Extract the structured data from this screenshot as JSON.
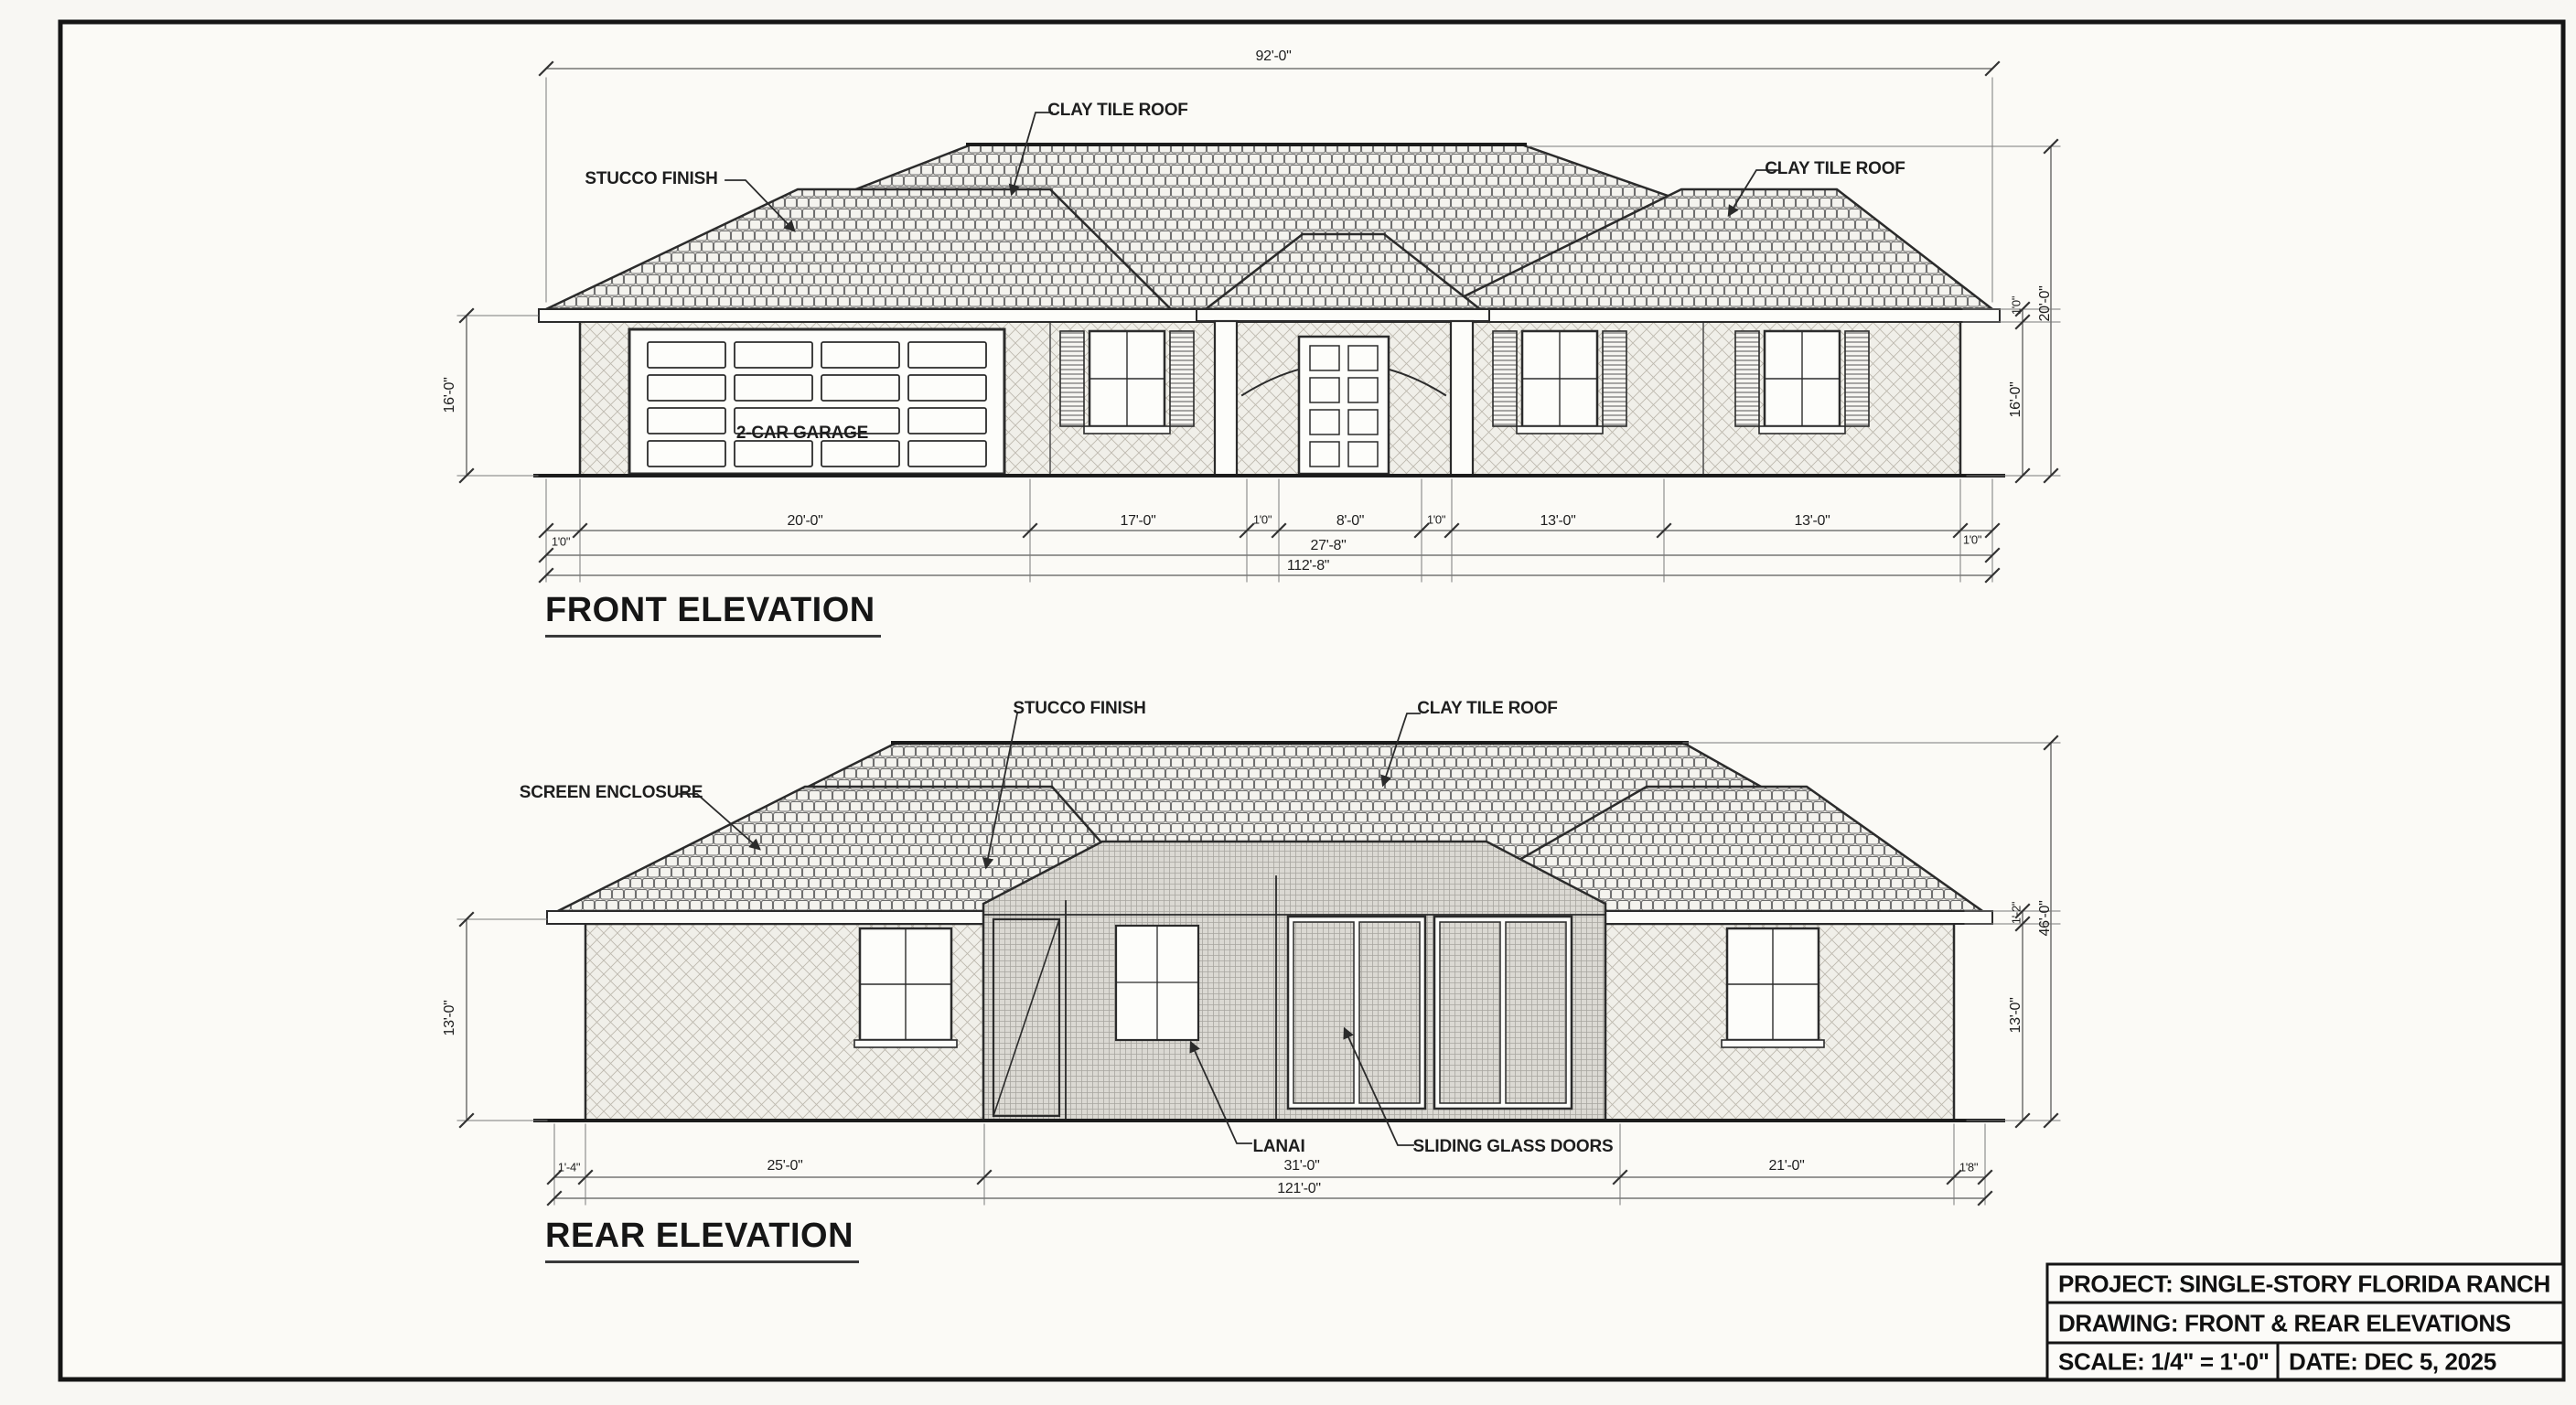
{
  "sheet": {
    "front": {
      "title": "FRONT ELEVATION",
      "dim_total_width": "92'-0\"",
      "label_stucco": "STUCCO FINISH",
      "label_clay_left": "CLAY TILE ROOF",
      "label_clay_right": "CLAY TILE ROOF",
      "label_garage": "2-CAR GARAGE",
      "dim_left_height": "16'-0\"",
      "dim_eave_offset": "1'0\"",
      "dim_wall_height": "16'-0\"",
      "dim_peak_height": "20'-0\"",
      "bottom_dims": [
        "1'0\"",
        "20'-0\"",
        "17'-0\"",
        "1'0\"",
        "8'-0\"",
        "1'0\"",
        "13'-0\"",
        "13'-0\"",
        "1'0\""
      ],
      "dim_mid_width": "27'-8\"",
      "dim_full_width": "112'-8\""
    },
    "rear": {
      "title": "REAR ELEVATION",
      "label_stucco": "STUCCO FINISH",
      "label_clay": "CLAY TILE ROOF",
      "label_screen": "SCREEN ENCLOSURE",
      "label_lanai": "LANAI",
      "label_sliding": "SLIDING GLASS DOORS",
      "dim_left_height": "13'-0\"",
      "dim_eave_offset": "1'-2\"",
      "dim_wall_height": "13'-0\"",
      "dim_peak_height": "46'-0\"",
      "bottom_dims": [
        "1'-4\"",
        "25'-0\"",
        "31'-0\"",
        "21'-0\"",
        "1'8\""
      ],
      "dim_full_width": "121'-0\""
    },
    "title_block": {
      "project": "PROJECT: SINGLE-STORY FLORIDA RANCH",
      "drawing": "DRAWING: FRONT & REAR ELEVATIONS",
      "scale": "SCALE: 1/4\" = 1'-0\"",
      "date": "DATE: DEC 5, 2025"
    }
  },
  "colors": {
    "ink": "#2b2b2b",
    "paper": "#f8f7f3"
  }
}
